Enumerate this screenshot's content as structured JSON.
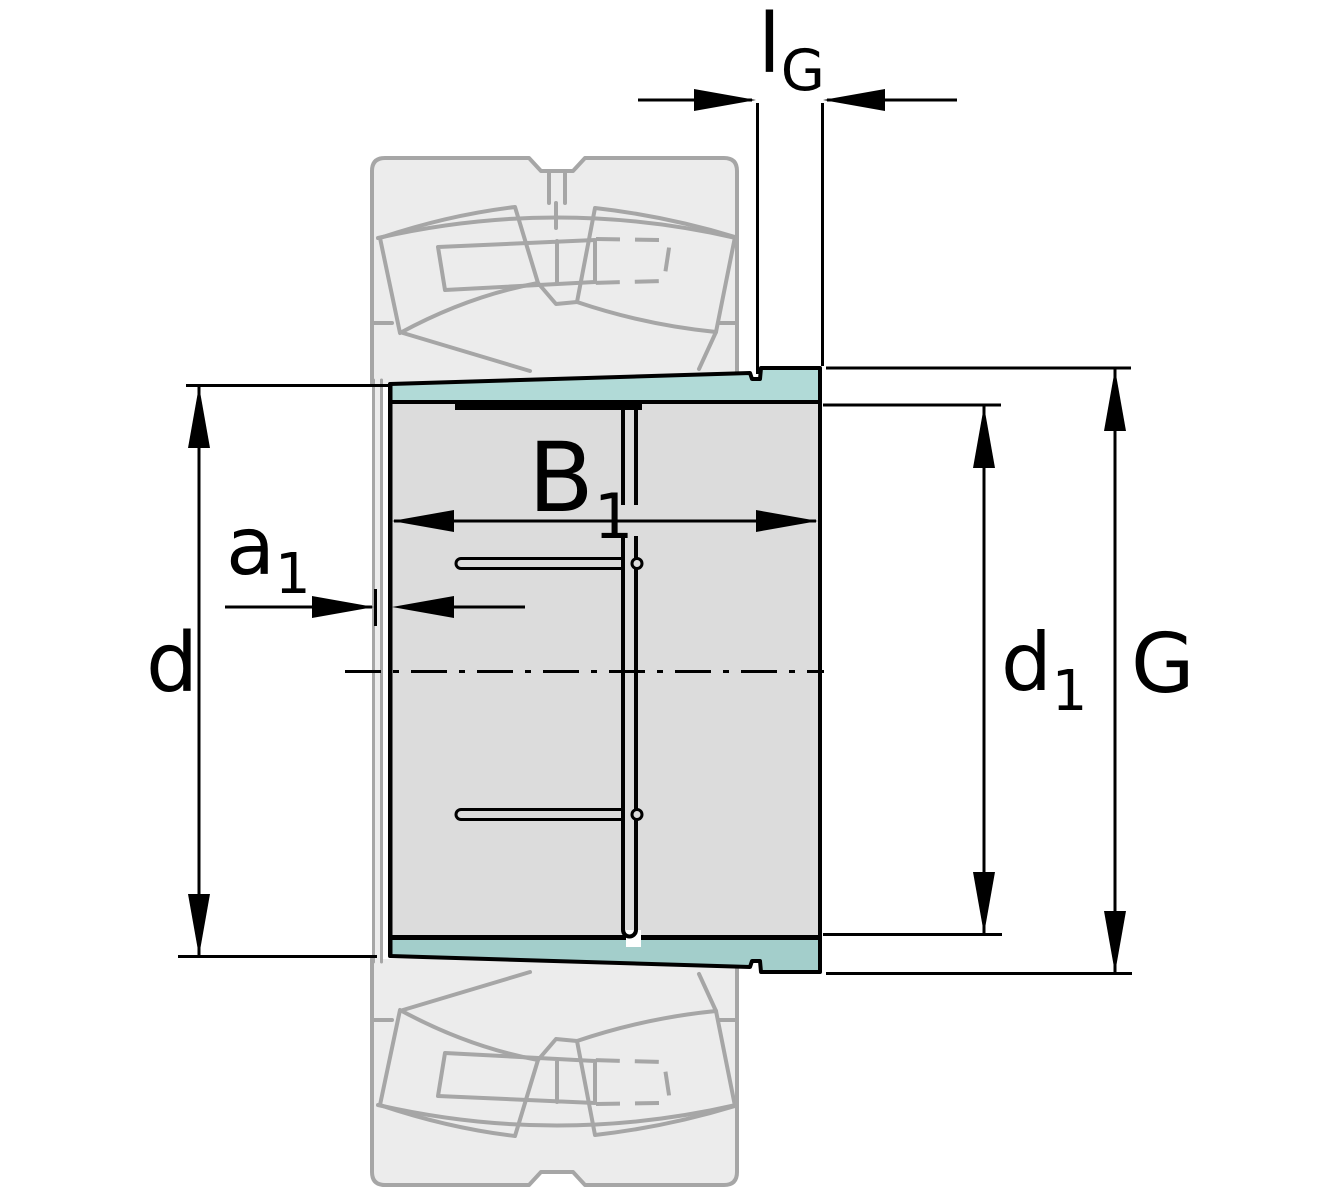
{
  "drawing": {
    "kind": "bearing adapter sleeve cross-section with spherical roller bearing ghost outline",
    "labels": {
      "lG": {
        "main": "l",
        "sub": "G"
      },
      "B1": {
        "main": "B",
        "sub": "1"
      },
      "a1": {
        "main": "a",
        "sub": "1"
      },
      "d": {
        "main": "d",
        "sub": ""
      },
      "d1": {
        "main": "d",
        "sub": "1"
      },
      "G": {
        "main": "G",
        "sub": ""
      }
    },
    "colors": {
      "background": "#ffffff",
      "ink": "#000000",
      "sleeve_fill": "#dcdcdc",
      "taper_top": "#b1dad7",
      "taper_bottom": "#a3cecb",
      "ghost_fill": "#ececec",
      "ghost_stroke": "#a6a6a6"
    }
  }
}
